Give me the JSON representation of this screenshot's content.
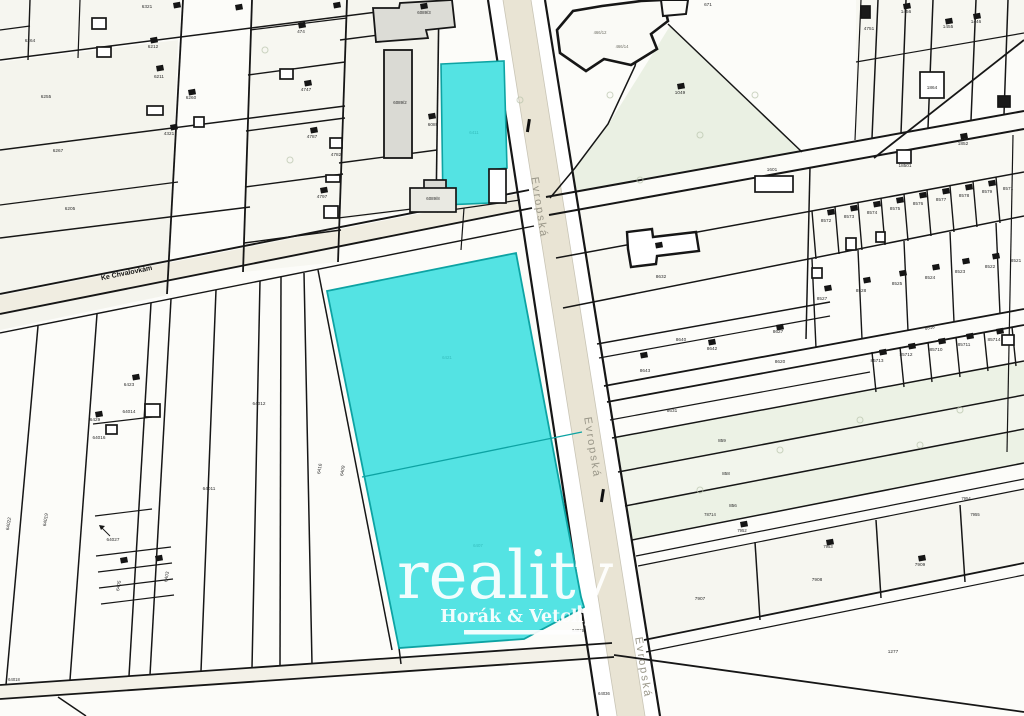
{
  "map": {
    "type": "cadastral-map",
    "highlight": {
      "color": "#54e3e3",
      "border": "#0da3a3",
      "divider": "#0da3a3"
    },
    "road_fill": "#e9e4d4",
    "watermark": {
      "brand": "reality",
      "subtitle": "Horák & Vetchý"
    },
    "streets": [
      {
        "name": "Evropská",
        "x": 536,
        "y": 208,
        "r": 81,
        "s": 11,
        "c": "#9a9789",
        "ls": 2
      },
      {
        "name": "Evropská",
        "x": 589,
        "y": 448,
        "r": 81,
        "s": 11,
        "c": "#9a9789",
        "ls": 2
      },
      {
        "name": "Evropská",
        "x": 640,
        "y": 668,
        "r": 81,
        "s": 11,
        "c": "#9a9789",
        "ls": 2
      },
      {
        "name": "Ke Chvalovkám",
        "x": 127,
        "y": 275,
        "r": -11.5,
        "s": 7,
        "c": "#141414",
        "b": 1,
        "ls": 0
      }
    ],
    "parcel_labels": [
      {
        "t": "6321",
        "x": 147,
        "y": 8
      },
      {
        "t": "6264",
        "x": 30,
        "y": 42
      },
      {
        "t": "6212",
        "x": 153,
        "y": 48
      },
      {
        "t": "6211",
        "x": 159,
        "y": 78
      },
      {
        "t": "6255",
        "x": 46,
        "y": 98
      },
      {
        "t": "6260",
        "x": 191,
        "y": 99
      },
      {
        "t": "6267",
        "x": 58,
        "y": 152
      },
      {
        "t": "4321",
        "x": 169,
        "y": 135
      },
      {
        "t": "6205",
        "x": 70,
        "y": 210
      },
      {
        "t": "474",
        "x": 301,
        "y": 33
      },
      {
        "t": "4747",
        "x": 306,
        "y": 91
      },
      {
        "t": "4787",
        "x": 312,
        "y": 138
      },
      {
        "t": "4782",
        "x": 336,
        "y": 156
      },
      {
        "t": "4797",
        "x": 322,
        "y": 198
      },
      {
        "t": "6089/2",
        "x": 400,
        "y": 104,
        "s": 4.4
      },
      {
        "t": "6089",
        "x": 433,
        "y": 126
      },
      {
        "t": "6089/8",
        "x": 433,
        "y": 200,
        "s": 4.4
      },
      {
        "t": "6089/3",
        "x": 424,
        "y": 14,
        "s": 4.4
      },
      {
        "t": "466/12",
        "x": 600,
        "y": 34,
        "c": "#6f6f66",
        "s": 4.2
      },
      {
        "t": "466/14",
        "x": 622,
        "y": 48,
        "c": "#6f6f66",
        "s": 4.2
      },
      {
        "t": "671",
        "x": 708,
        "y": 6
      },
      {
        "t": "1049",
        "x": 680,
        "y": 94
      },
      {
        "t": "4751",
        "x": 869,
        "y": 30
      },
      {
        "t": "1456",
        "x": 906,
        "y": 13
      },
      {
        "t": "1455",
        "x": 948,
        "y": 28
      },
      {
        "t": "1446",
        "x": 976,
        "y": 23
      },
      {
        "t": "1864",
        "x": 932,
        "y": 89
      },
      {
        "t": "18501",
        "x": 905,
        "y": 167
      },
      {
        "t": "1852",
        "x": 963,
        "y": 145
      },
      {
        "t": "1601",
        "x": 772,
        "y": 171
      },
      {
        "t": "8572",
        "x": 826,
        "y": 222
      },
      {
        "t": "8573",
        "x": 849,
        "y": 218
      },
      {
        "t": "8574",
        "x": 872,
        "y": 214
      },
      {
        "t": "8575",
        "x": 895,
        "y": 210
      },
      {
        "t": "8576",
        "x": 918,
        "y": 205
      },
      {
        "t": "8577",
        "x": 941,
        "y": 201
      },
      {
        "t": "8578",
        "x": 964,
        "y": 197
      },
      {
        "t": "8579",
        "x": 987,
        "y": 193
      },
      {
        "t": "8571",
        "x": 1008,
        "y": 190
      },
      {
        "t": "8527",
        "x": 822,
        "y": 300
      },
      {
        "t": "8528",
        "x": 861,
        "y": 292
      },
      {
        "t": "8525",
        "x": 897,
        "y": 285
      },
      {
        "t": "8524",
        "x": 930,
        "y": 279
      },
      {
        "t": "8523",
        "x": 960,
        "y": 273
      },
      {
        "t": "8522",
        "x": 990,
        "y": 268
      },
      {
        "t": "8521",
        "x": 1016,
        "y": 262
      },
      {
        "t": "8518",
        "x": 930,
        "y": 329,
        "r": -10.5,
        "s": 4.4
      },
      {
        "t": "85713",
        "x": 877,
        "y": 362
      },
      {
        "t": "85712",
        "x": 906,
        "y": 356
      },
      {
        "t": "85710",
        "x": 936,
        "y": 351
      },
      {
        "t": "85711",
        "x": 964,
        "y": 346
      },
      {
        "t": "85714",
        "x": 994,
        "y": 341
      },
      {
        "t": "8643",
        "x": 645,
        "y": 372
      },
      {
        "t": "8642",
        "x": 712,
        "y": 350
      },
      {
        "t": "8640",
        "x": 681,
        "y": 341
      },
      {
        "t": "8627",
        "x": 778,
        "y": 333
      },
      {
        "t": "8620",
        "x": 780,
        "y": 363
      },
      {
        "t": "8631",
        "x": 672,
        "y": 412
      },
      {
        "t": "8632",
        "x": 661,
        "y": 278
      },
      {
        "t": "859",
        "x": 722,
        "y": 442
      },
      {
        "t": "858",
        "x": 726,
        "y": 475
      },
      {
        "t": "856",
        "x": 733,
        "y": 507
      },
      {
        "t": "7954",
        "x": 966,
        "y": 500,
        "s": 4.2
      },
      {
        "t": "7955",
        "x": 975,
        "y": 516,
        "s": 4.2
      },
      {
        "t": "78714",
        "x": 710,
        "y": 516,
        "s": 4.2
      },
      {
        "t": "7952",
        "x": 742,
        "y": 532,
        "s": 4.2
      },
      {
        "t": "7953",
        "x": 828,
        "y": 548,
        "s": 4.2
      },
      {
        "t": "7907",
        "x": 700,
        "y": 600
      },
      {
        "t": "7908",
        "x": 817,
        "y": 581
      },
      {
        "t": "7909",
        "x": 920,
        "y": 566
      },
      {
        "t": "1277",
        "x": 893,
        "y": 653
      },
      {
        "t": "64036",
        "x": 604,
        "y": 695,
        "s": 4.2
      },
      {
        "t": "64018",
        "x": 14,
        "y": 681,
        "s": 4.2
      },
      {
        "t": "64015",
        "x": 578,
        "y": 632,
        "s": 4.2
      },
      {
        "t": "64022",
        "x": 10,
        "y": 524,
        "r": -80
      },
      {
        "t": "64019",
        "x": 47,
        "y": 520,
        "r": -80
      },
      {
        "t": "6429",
        "x": 95,
        "y": 421
      },
      {
        "t": "64016",
        "x": 99,
        "y": 439
      },
      {
        "t": "6423",
        "x": 129,
        "y": 386
      },
      {
        "t": "64014",
        "x": 129,
        "y": 413
      },
      {
        "t": "64012",
        "x": 259,
        "y": 405
      },
      {
        "t": "64011",
        "x": 209,
        "y": 490
      },
      {
        "t": "64027",
        "x": 113,
        "y": 541
      },
      {
        "t": "6416",
        "x": 321,
        "y": 469,
        "r": -80
      },
      {
        "t": "6409",
        "x": 344,
        "y": 471,
        "r": -80
      },
      {
        "t": "6405",
        "x": 120,
        "y": 586,
        "r": -80
      },
      {
        "t": "6403",
        "x": 168,
        "y": 577,
        "r": -80
      },
      {
        "t": "6411",
        "x": 474,
        "y": 134,
        "c": "#35bdbd",
        "s": 4.4
      },
      {
        "t": "6421",
        "x": 447,
        "y": 359,
        "c": "#35bdbd",
        "s": 4.4
      },
      {
        "t": "6407",
        "x": 478,
        "y": 547,
        "c": "#35bdbd",
        "s": 4.4
      }
    ],
    "building_marks": [
      [
        150,
        38
      ],
      [
        156,
        66
      ],
      [
        188,
        90
      ],
      [
        170,
        125
      ],
      [
        298,
        23
      ],
      [
        304,
        81
      ],
      [
        310,
        128
      ],
      [
        320,
        188
      ],
      [
        173,
        3
      ],
      [
        235,
        5
      ],
      [
        333,
        3
      ],
      [
        420,
        4
      ],
      [
        428,
        114
      ],
      [
        95,
        412
      ],
      [
        132,
        375
      ],
      [
        120,
        558
      ],
      [
        155,
        556
      ],
      [
        827,
        210
      ],
      [
        850,
        206
      ],
      [
        873,
        202
      ],
      [
        896,
        198
      ],
      [
        919,
        193
      ],
      [
        942,
        189
      ],
      [
        965,
        185
      ],
      [
        988,
        181
      ],
      [
        824,
        286
      ],
      [
        863,
        278
      ],
      [
        899,
        271
      ],
      [
        932,
        265
      ],
      [
        962,
        259
      ],
      [
        992,
        254
      ],
      [
        879,
        350
      ],
      [
        908,
        344
      ],
      [
        938,
        339
      ],
      [
        966,
        334
      ],
      [
        996,
        329
      ],
      [
        740,
        522
      ],
      [
        826,
        540
      ],
      [
        918,
        556
      ],
      [
        640,
        353
      ],
      [
        708,
        340
      ],
      [
        776,
        325
      ],
      [
        677,
        84
      ],
      [
        960,
        134
      ],
      [
        945,
        19
      ],
      [
        903,
        4
      ],
      [
        973,
        14
      ],
      [
        655,
        243
      ]
    ],
    "building_outlines": [
      [
        92,
        18,
        14,
        11
      ],
      [
        97,
        47,
        14,
        10
      ],
      [
        147,
        106,
        16,
        9
      ],
      [
        194,
        117,
        10,
        10
      ],
      [
        280,
        69,
        13,
        10
      ],
      [
        330,
        138,
        12,
        10
      ],
      [
        324,
        206,
        14,
        12
      ],
      [
        326,
        175,
        14,
        7
      ],
      [
        145,
        404,
        15,
        13
      ],
      [
        106,
        425,
        11,
        9
      ],
      [
        920,
        72,
        24,
        26
      ],
      [
        897,
        150,
        14,
        13
      ],
      [
        755,
        176,
        38,
        16
      ],
      [
        846,
        238,
        10,
        12
      ],
      [
        876,
        232,
        9,
        10
      ],
      [
        812,
        268,
        10,
        10
      ],
      [
        1002,
        335,
        12,
        10
      ],
      [
        489,
        169,
        17,
        34,
        "#ffffff"
      ],
      [
        424,
        180,
        22,
        16,
        "#d9d9d3"
      ],
      [
        410,
        188,
        46,
        24,
        "#e9e9e2"
      ],
      [
        861,
        6,
        9,
        12,
        "#1a1a1a"
      ],
      [
        998,
        96,
        12,
        11,
        "#1a1a1a"
      ]
    ],
    "trees": [
      [
        520,
        100
      ],
      [
        610,
        95
      ],
      [
        700,
        135
      ],
      [
        755,
        95
      ],
      [
        640,
        180
      ],
      [
        860,
        420
      ],
      [
        920,
        445
      ],
      [
        780,
        450
      ],
      [
        700,
        490
      ],
      [
        960,
        410
      ],
      [
        265,
        50
      ],
      [
        290,
        160
      ]
    ]
  }
}
